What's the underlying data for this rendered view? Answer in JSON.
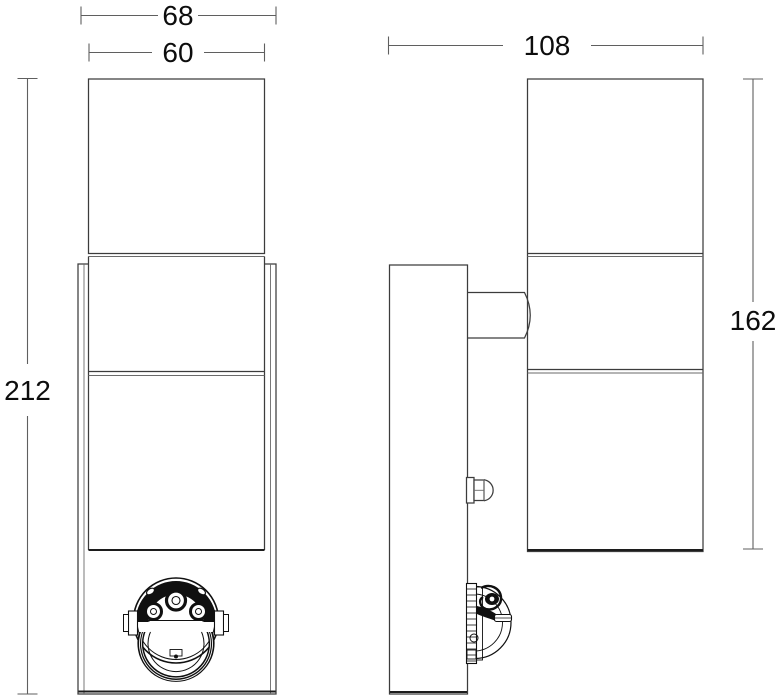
{
  "drawing": {
    "background": "#ffffff",
    "outline_color": "#3c3c3c",
    "detail_color": "#101010",
    "dimension_line_color": "#5f5f5f",
    "dimension_labels": {
      "overall_width": "68",
      "tube_diameter": "60",
      "overall_depth": "108",
      "overall_height": "212",
      "tube_length": "162"
    }
  }
}
